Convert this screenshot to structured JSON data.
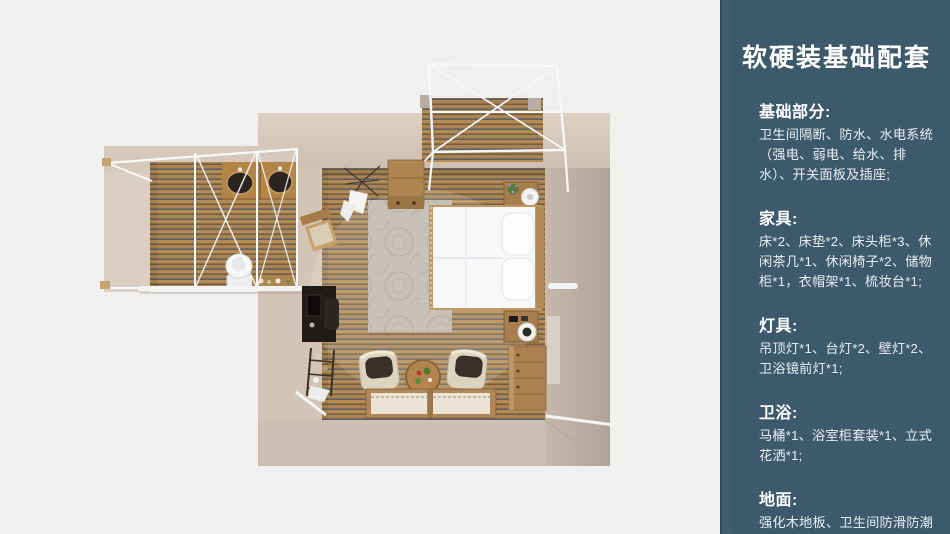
{
  "colors": {
    "page_bg": "#f0f0ef",
    "panel_bg": "#3d5a6c",
    "panel_edge": "#2f4b5c",
    "heading_color": "#ffffff",
    "body_color": "#e9eef2",
    "floor_wood": "#b68b52",
    "wall_beige": "#d3c5b6",
    "frame_white": "#f6f7f8"
  },
  "panel": {
    "title": "软硬装基础配套",
    "sections": [
      {
        "heading": "基础部分:",
        "body": "卫生间隔断、防水、水电系统（强电、弱电、给水、排水）、开关面板及插座;"
      },
      {
        "heading": "家具:",
        "body": "床*2、床垫*2、床头柜*3、休闲茶几*1、休闲椅子*2、储物柜*1，衣帽架*1、梳妆台*1;"
      },
      {
        "heading": "灯具:",
        "body": "吊顶灯*1、台灯*2、壁灯*2、卫浴镜前灯*1;"
      },
      {
        "heading": "卫浴:",
        "body": "马桶*1、浴室柜套装*1、立式花洒*1;"
      },
      {
        "heading": "地面:",
        "body": "强化木地板、卫生间防滑防潮石塑板;"
      }
    ]
  },
  "floorplan": {
    "rooms": [
      "bedroom",
      "bathroom-wing",
      "deck"
    ],
    "furniture": [
      "bed",
      "pillows",
      "nightstand-top",
      "nightstand-bottom",
      "wardrobe-cabinet",
      "rug",
      "desk",
      "desk-chair",
      "shelf-rack",
      "coat-rack",
      "side-chair",
      "armchair-left",
      "armchair-right",
      "round-tea-table",
      "low-window-table",
      "drawer-dresser",
      "double-sink-counter",
      "toilet",
      "canopy-frames"
    ]
  }
}
